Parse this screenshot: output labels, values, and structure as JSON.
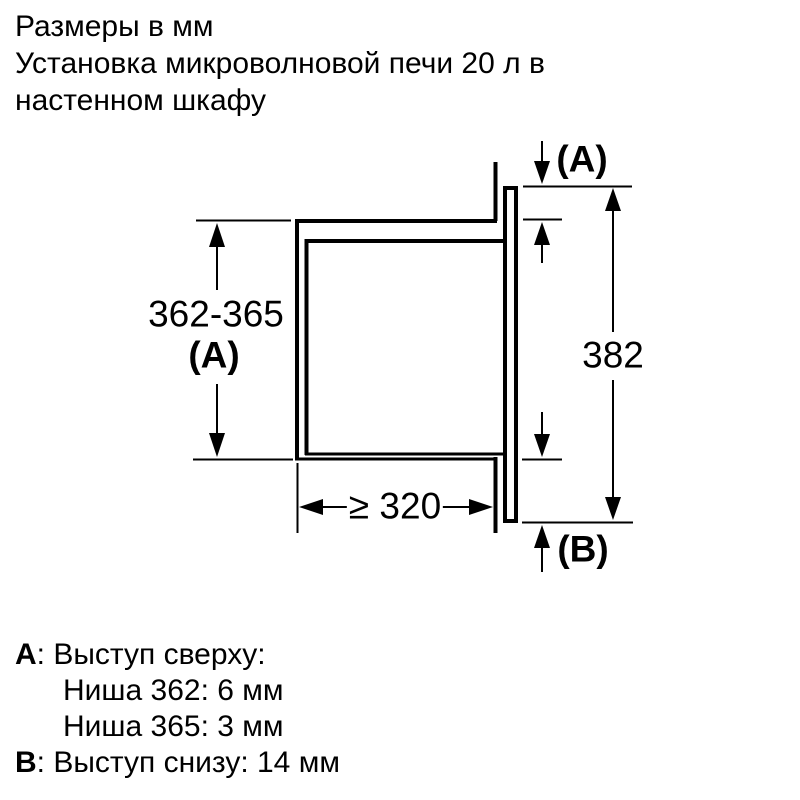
{
  "title": {
    "lines": [
      "Размеры в мм",
      "Установка микроволновой печи 20 л в",
      "настенном шкафу"
    ]
  },
  "diagram": {
    "niche_height": "362-365",
    "ref_a": "(A)",
    "ref_b": "(B)",
    "frame_height": "382",
    "min_depth": "≥ 320"
  },
  "legend": {
    "item_a": {
      "key": "A",
      "text": ": Выступ сверху:",
      "sub": [
        "Ниша 362: 6 мм",
        "Ниша 365: 3 мм"
      ]
    },
    "item_b": {
      "key": "B",
      "text": ": Выступ снизу: 14 мм"
    }
  },
  "colors": {
    "ink": "#000000",
    "background": "#ffffff"
  }
}
